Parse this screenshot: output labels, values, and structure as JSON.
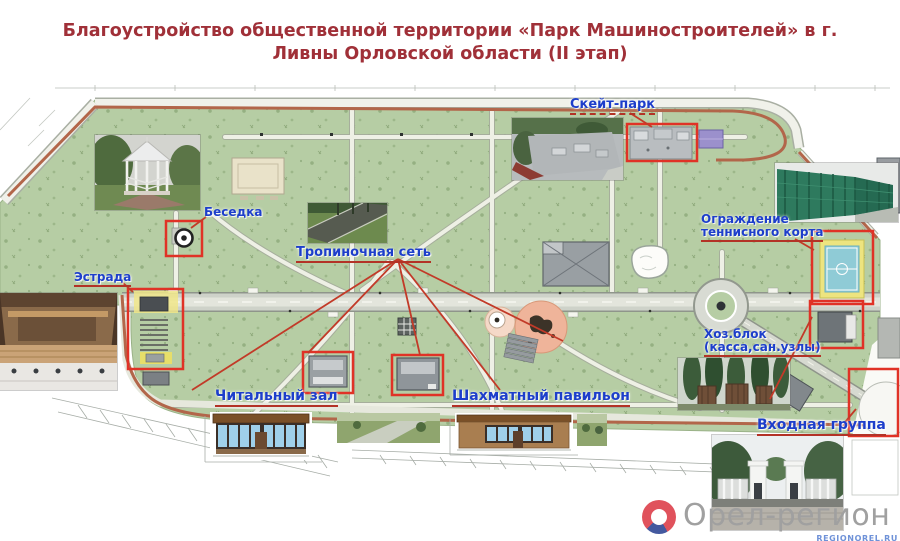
{
  "title": {
    "line1": "Благоустройство общественной территории «Парк Машиностроителей» в г.",
    "line2": "Ливны Орловской области (II этап)"
  },
  "labels": {
    "skate_park": "Скейт-парк",
    "gazebo": "Беседка",
    "stage": "Эстрада",
    "path_network": "Тропиночная сеть",
    "tennis_fence_line1": "Ограждение",
    "tennis_fence_line2": "теннисного корта",
    "utility_line1": "Хоз.блок",
    "utility_line2": "(касса,сан.узлы)",
    "reading_room": "Читальный зал",
    "chess_pavilion": "Шахматный павильон",
    "entrance_group": "Входная группа"
  },
  "logo": {
    "name": "Орел-регион",
    "site": "REGIONOREL.RU"
  },
  "colors": {
    "title_red": "#a03038",
    "label_blue": "#1d3ecb",
    "highlight_red": "#e03226",
    "underline_red": "#b33226",
    "park_green": "#b6cda4",
    "perimeter_brown": "#b2664a",
    "court_yellow": "#ede47f",
    "court_blue": "#8fcbd6",
    "logo_gray": "#a0a0a0",
    "logo_red": "#e0525c",
    "logo_blue": "#44599f",
    "site_link_blue": "#6f92d8"
  }
}
